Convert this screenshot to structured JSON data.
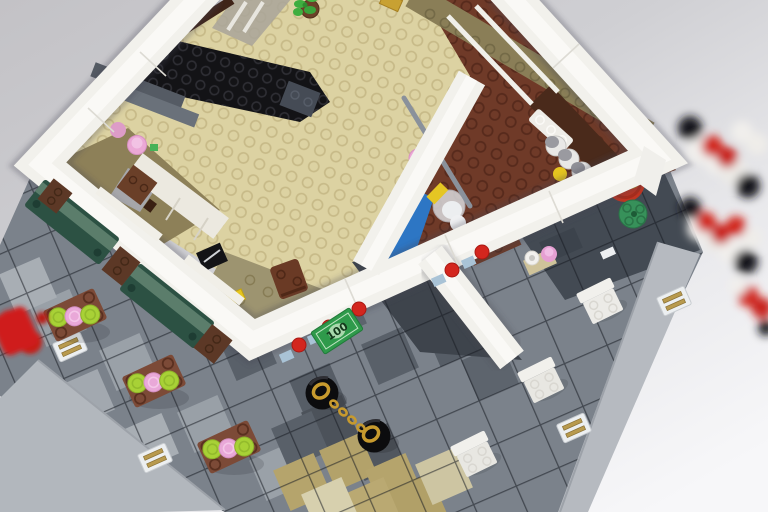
{
  "meta": {
    "title": "Overhead photo of a LEGO modular corner cafe on a gray tiled plaza",
    "domain": "natural-image"
  },
  "scene": {
    "money_bill": {
      "label": "100",
      "value": 100
    },
    "counts": {
      "cafe_tables": 3,
      "white_chairs": 3,
      "benches": 2,
      "planters": 3,
      "drain_grilles": 4,
      "spice_canisters": 4,
      "yellow_cups": 2,
      "red_flower_studs": 5,
      "scooter_wheels": 2,
      "awning_rolls": 2
    },
    "palette": {
      "backdrop_top": "#c5c4c8",
      "backdrop_bottom": "#f6f6f8",
      "wall_white": "#f2f1ec",
      "tan_floor": "#dcd2a2",
      "olive_floor": "#8a7e57",
      "kitchen_brown": "#6f3a28",
      "stairs_black": "#131316",
      "step_gray": "#5d636c",
      "cabinet_white": "#ece9e0",
      "counter_blue": "#2d76c4",
      "plaza_base": "#7b828b",
      "plaza_dark": "#434a53",
      "plaza_light": "#99a0a7",
      "plaza_tan": "#b5a46c",
      "plaza_border": "#b6bac0",
      "bench_green": "#2c5143",
      "bench_top": "#5b7d6b",
      "planter_brown": "#5c3826",
      "table_brown": "#7c4a37",
      "plate_lime": "#a8d136",
      "plate_pink": "#e9a8d8",
      "chair_white": "#ecebe7",
      "scooter_black": "#0c0c0e",
      "gold": "#c79a2e",
      "bill_green": "#2f9a4b",
      "bill_text": "#14381c",
      "flower_red": "#d3261e",
      "barrel_red": "#bf3522",
      "barrel_lid_gold": "#d4aa3e",
      "canister_white": "#e9e8e6",
      "canister_top": "#9a9aa0",
      "cup_yellow": "#e6c51f",
      "round_plate_green": "#37915a",
      "awning_red": "#d1251d",
      "awning_white": "#f1efec",
      "hydrant_red": "#cf1f1a",
      "grille_white": "#eceff1",
      "grille_gold": "#b89a4e",
      "window_glass": "#a9a49a",
      "plant_green": "#3fae3f"
    },
    "objects": [
      "white corner building walls",
      "black interior staircase",
      "tan studded cafe floor",
      "reddish-brown kitchen floor",
      "shelf with spice canisters and yellow cups",
      "red barrel with gold lid",
      "blue kitchen counter",
      "cooking pot with ladle",
      "dark green benches with brown planters",
      "three brown cafe tables with lime and pink plates",
      "three white chairs",
      "scooter wheels with gold chain",
      "green 100 money tile",
      "red flower studs along wall base",
      "red fire hydrant",
      "red and white rolled awnings",
      "storm drain grilles",
      "potted plant"
    ]
  }
}
